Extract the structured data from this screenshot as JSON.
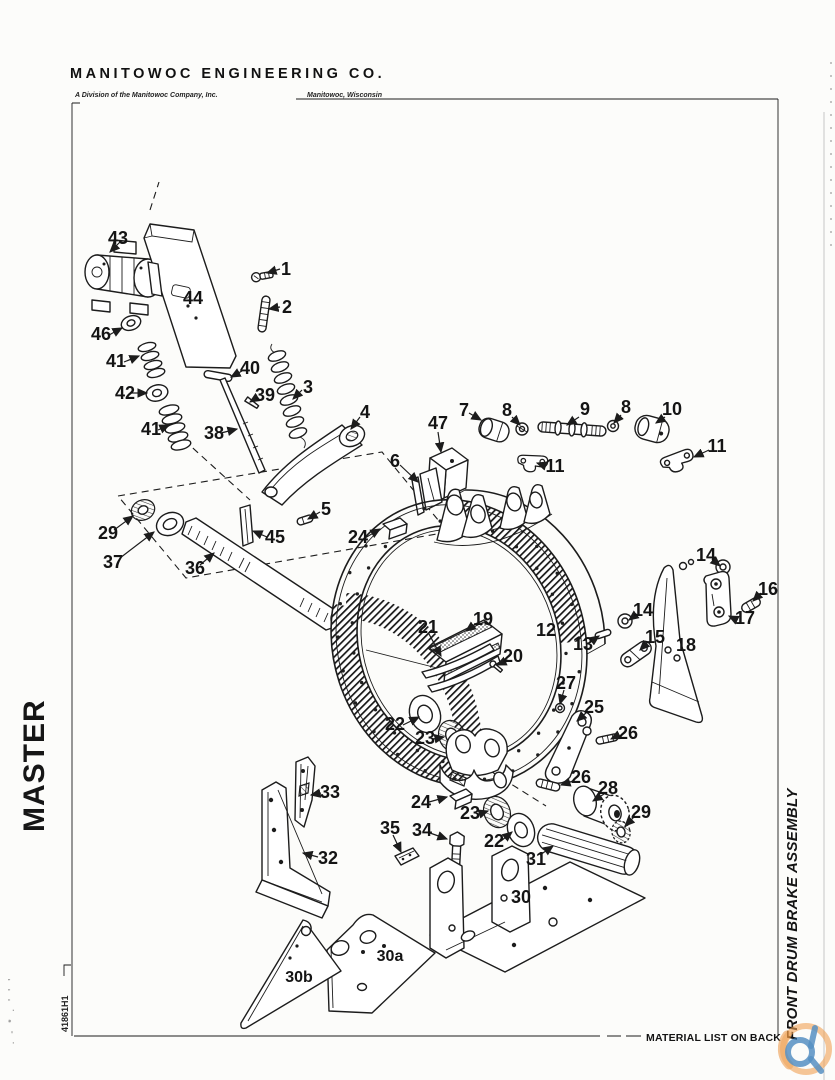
{
  "header": {
    "company": "MANITOWOC ENGINEERING CO.",
    "division": "A Division of the Manitowoc Company, Inc.",
    "location": "Manitowoc, Wisconsin"
  },
  "margins": {
    "master": "MASTER",
    "doc_number": "41861H1",
    "assembly_title": "FRONT DRUM BRAKE ASSEMBLY",
    "material_note": "MATERIAL LIST ON BACK",
    "edge_marks": ". - * . ' ' '"
  },
  "diagram": {
    "description": "Exploded parts view, front drum brake assembly",
    "parts": {
      "p1": "1",
      "p2": "2",
      "p3": "3",
      "p4": "4",
      "p5": "5",
      "p6": "6",
      "p7": "7",
      "p8a": "8",
      "p8b": "8",
      "p9": "9",
      "p10": "10",
      "p11a": "11",
      "p11b": "11",
      "p12": "12",
      "p13": "13",
      "p14a": "14",
      "p14b": "14",
      "p15": "15",
      "p16": "16",
      "p17": "17",
      "p18": "18",
      "p19": "19",
      "p20": "20",
      "p21": "21",
      "p22a": "22",
      "p22b": "22",
      "p23a": "23",
      "p23b": "23",
      "p24a": "24",
      "p24b": "24",
      "p25": "25",
      "p26a": "26",
      "p26b": "26",
      "p27": "27",
      "p28": "28",
      "p29a": "29",
      "p29b": "29",
      "p30": "30",
      "p30a": "30a",
      "p30b": "30b",
      "p31": "31",
      "p32": "32",
      "p33": "33",
      "p34": "34",
      "p35": "35",
      "p36": "36",
      "p37": "37",
      "p38": "38",
      "p39": "39",
      "p40": "40",
      "p41a": "41",
      "p41b": "41",
      "p42": "42",
      "p43": "43",
      "p44": "44",
      "p45": "45",
      "p46": "46",
      "p47": "47"
    }
  },
  "watermark": {
    "name": "crane-network-logo",
    "ring_color": "#f0a053",
    "glyph_color": "#2e76b5"
  }
}
